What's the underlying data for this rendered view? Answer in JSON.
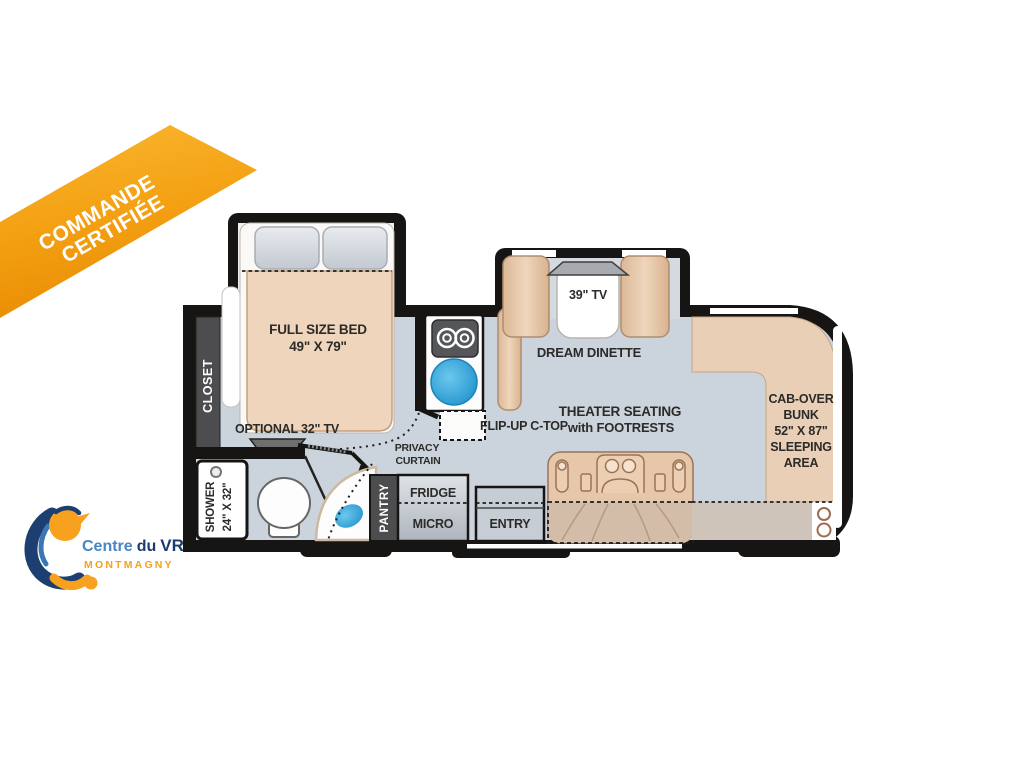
{
  "banner": {
    "line1": "COMMANDE",
    "line2": "CERTIFIÉE",
    "color_top": "#f9b32b",
    "color_bottom": "#ea8f05"
  },
  "logo": {
    "name_part1": "Centre",
    "name_part2": "du",
    "name_part3": "VR",
    "city": "MONTMAGNY",
    "blue_light": "#4a86c3",
    "blue_dark": "#1c3c6f",
    "orange": "#f5a01d"
  },
  "floorplan": {
    "bedroom": {
      "closet": "CLOSET",
      "bed_line1": "FULL SIZE BED",
      "bed_line2": "49\" X 79\"",
      "tv": "OPTIONAL 32\" TV"
    },
    "bath": {
      "shower_line1": "SHOWER",
      "shower_line2": "24\" X 32\""
    },
    "kitchen": {
      "pantry": "PANTRY",
      "fridge": "FRIDGE",
      "micro": "MICRO",
      "flip_up": "FLIP-UP C-TOP",
      "privacy_line1": "PRIVACY",
      "privacy_line2": "CURTAIN"
    },
    "entry": "ENTRY",
    "dinette": {
      "tv": "39\" TV",
      "label": "DREAM DINETTE"
    },
    "theater": {
      "line1": "THEATER SEATING",
      "line2": "with FOOTRESTS"
    },
    "bunk": {
      "line1": "CAB-OVER",
      "line2": "BUNK",
      "line3": "52\" X 87\"",
      "line4": "SLEEPING",
      "line5": "AREA"
    },
    "colors": {
      "wall": "#161513",
      "floor": "#cbd4dc",
      "furniture_tan": "#e9cdb0",
      "sink_blue": "#36ace2"
    }
  }
}
